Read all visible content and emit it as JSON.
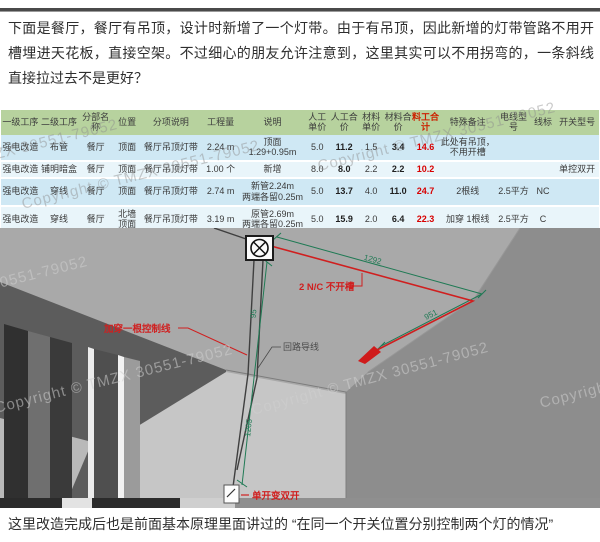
{
  "page": {
    "top_paragraph": "下面是餐厅，餐厅有吊顶，设计时新增了一个灯带。由于有吊顶，因此新增的灯带管路不用开槽埋进天花板，直接空架。不过细心的朋友允许注意到，这里其实可以不用拐弯的，一条斜线直接拉过去不是更好？",
    "bottom_paragraph": "这里改造完成后也是前面基本原理里面讲过的 “在同一个开关位置分别控制两个灯的情况”",
    "watermark_text": "Copyright © TMZX 30551-79052"
  },
  "table": {
    "headers": [
      "一级工序",
      "二级工序",
      "分部名称",
      "位置",
      "分项说明",
      "工程量",
      "说明",
      "人工单价",
      "人工合价",
      "材料单价",
      "材料合价",
      "料工合计",
      "特殊备注",
      "电线型号",
      "线标",
      "开关型号"
    ],
    "rows": [
      [
        "强电改造",
        "布管",
        "餐厅",
        "顶面",
        "餐厅吊顶灯带",
        "2.24 m",
        "顶面\n1.29+0.95m",
        "5.0",
        "11.2",
        "1.5",
        "3.4",
        "14.6",
        "此处有吊顶，不用开槽",
        "",
        "",
        ""
      ],
      [
        "强电改造",
        "铺明暗盒",
        "餐厅",
        "顶面",
        "餐厅吊顶灯带",
        "1.00 个",
        "新增",
        "8.0",
        "8.0",
        "2.2",
        "2.2",
        "10.2",
        "",
        "",
        "",
        "单控双开"
      ],
      [
        "强电改造",
        "穿线",
        "餐厅",
        "顶面",
        "餐厅吊顶灯带",
        "2.74 m",
        "新管2.24m\n两端各留0.25m",
        "5.0",
        "13.7",
        "4.0",
        "11.0",
        "24.7",
        "2根线",
        "2.5平方",
        "NC",
        ""
      ],
      [
        "强电改造",
        "穿线",
        "餐厅",
        "北墙\n顶面",
        "餐厅吊顶灯带",
        "3.19 m",
        "原管2.69m\n两端各留0.25m",
        "5.0",
        "15.9",
        "2.0",
        "6.4",
        "22.3",
        "加穿 1根线",
        "2.5平方",
        "C",
        ""
      ]
    ]
  },
  "scene": {
    "labels": {
      "no_groove": "2 N/C 不开槽",
      "add_control_wire": "加穿一根控制线",
      "circuit_wire": "回路导线",
      "switch_change": "单开变双开"
    },
    "dimensions": {
      "diag_top": "1292",
      "diag_right": "951",
      "vertical": "1205",
      "vertical_small": "95"
    },
    "colors": {
      "dimension_green": "#1f7a54",
      "annotation_red": "#d01f1f",
      "table_header_green": "#b7d29e",
      "row_blue": "#cfe8f4",
      "row_light": "#e9f5fa",
      "total_red": "#cc2200"
    }
  }
}
